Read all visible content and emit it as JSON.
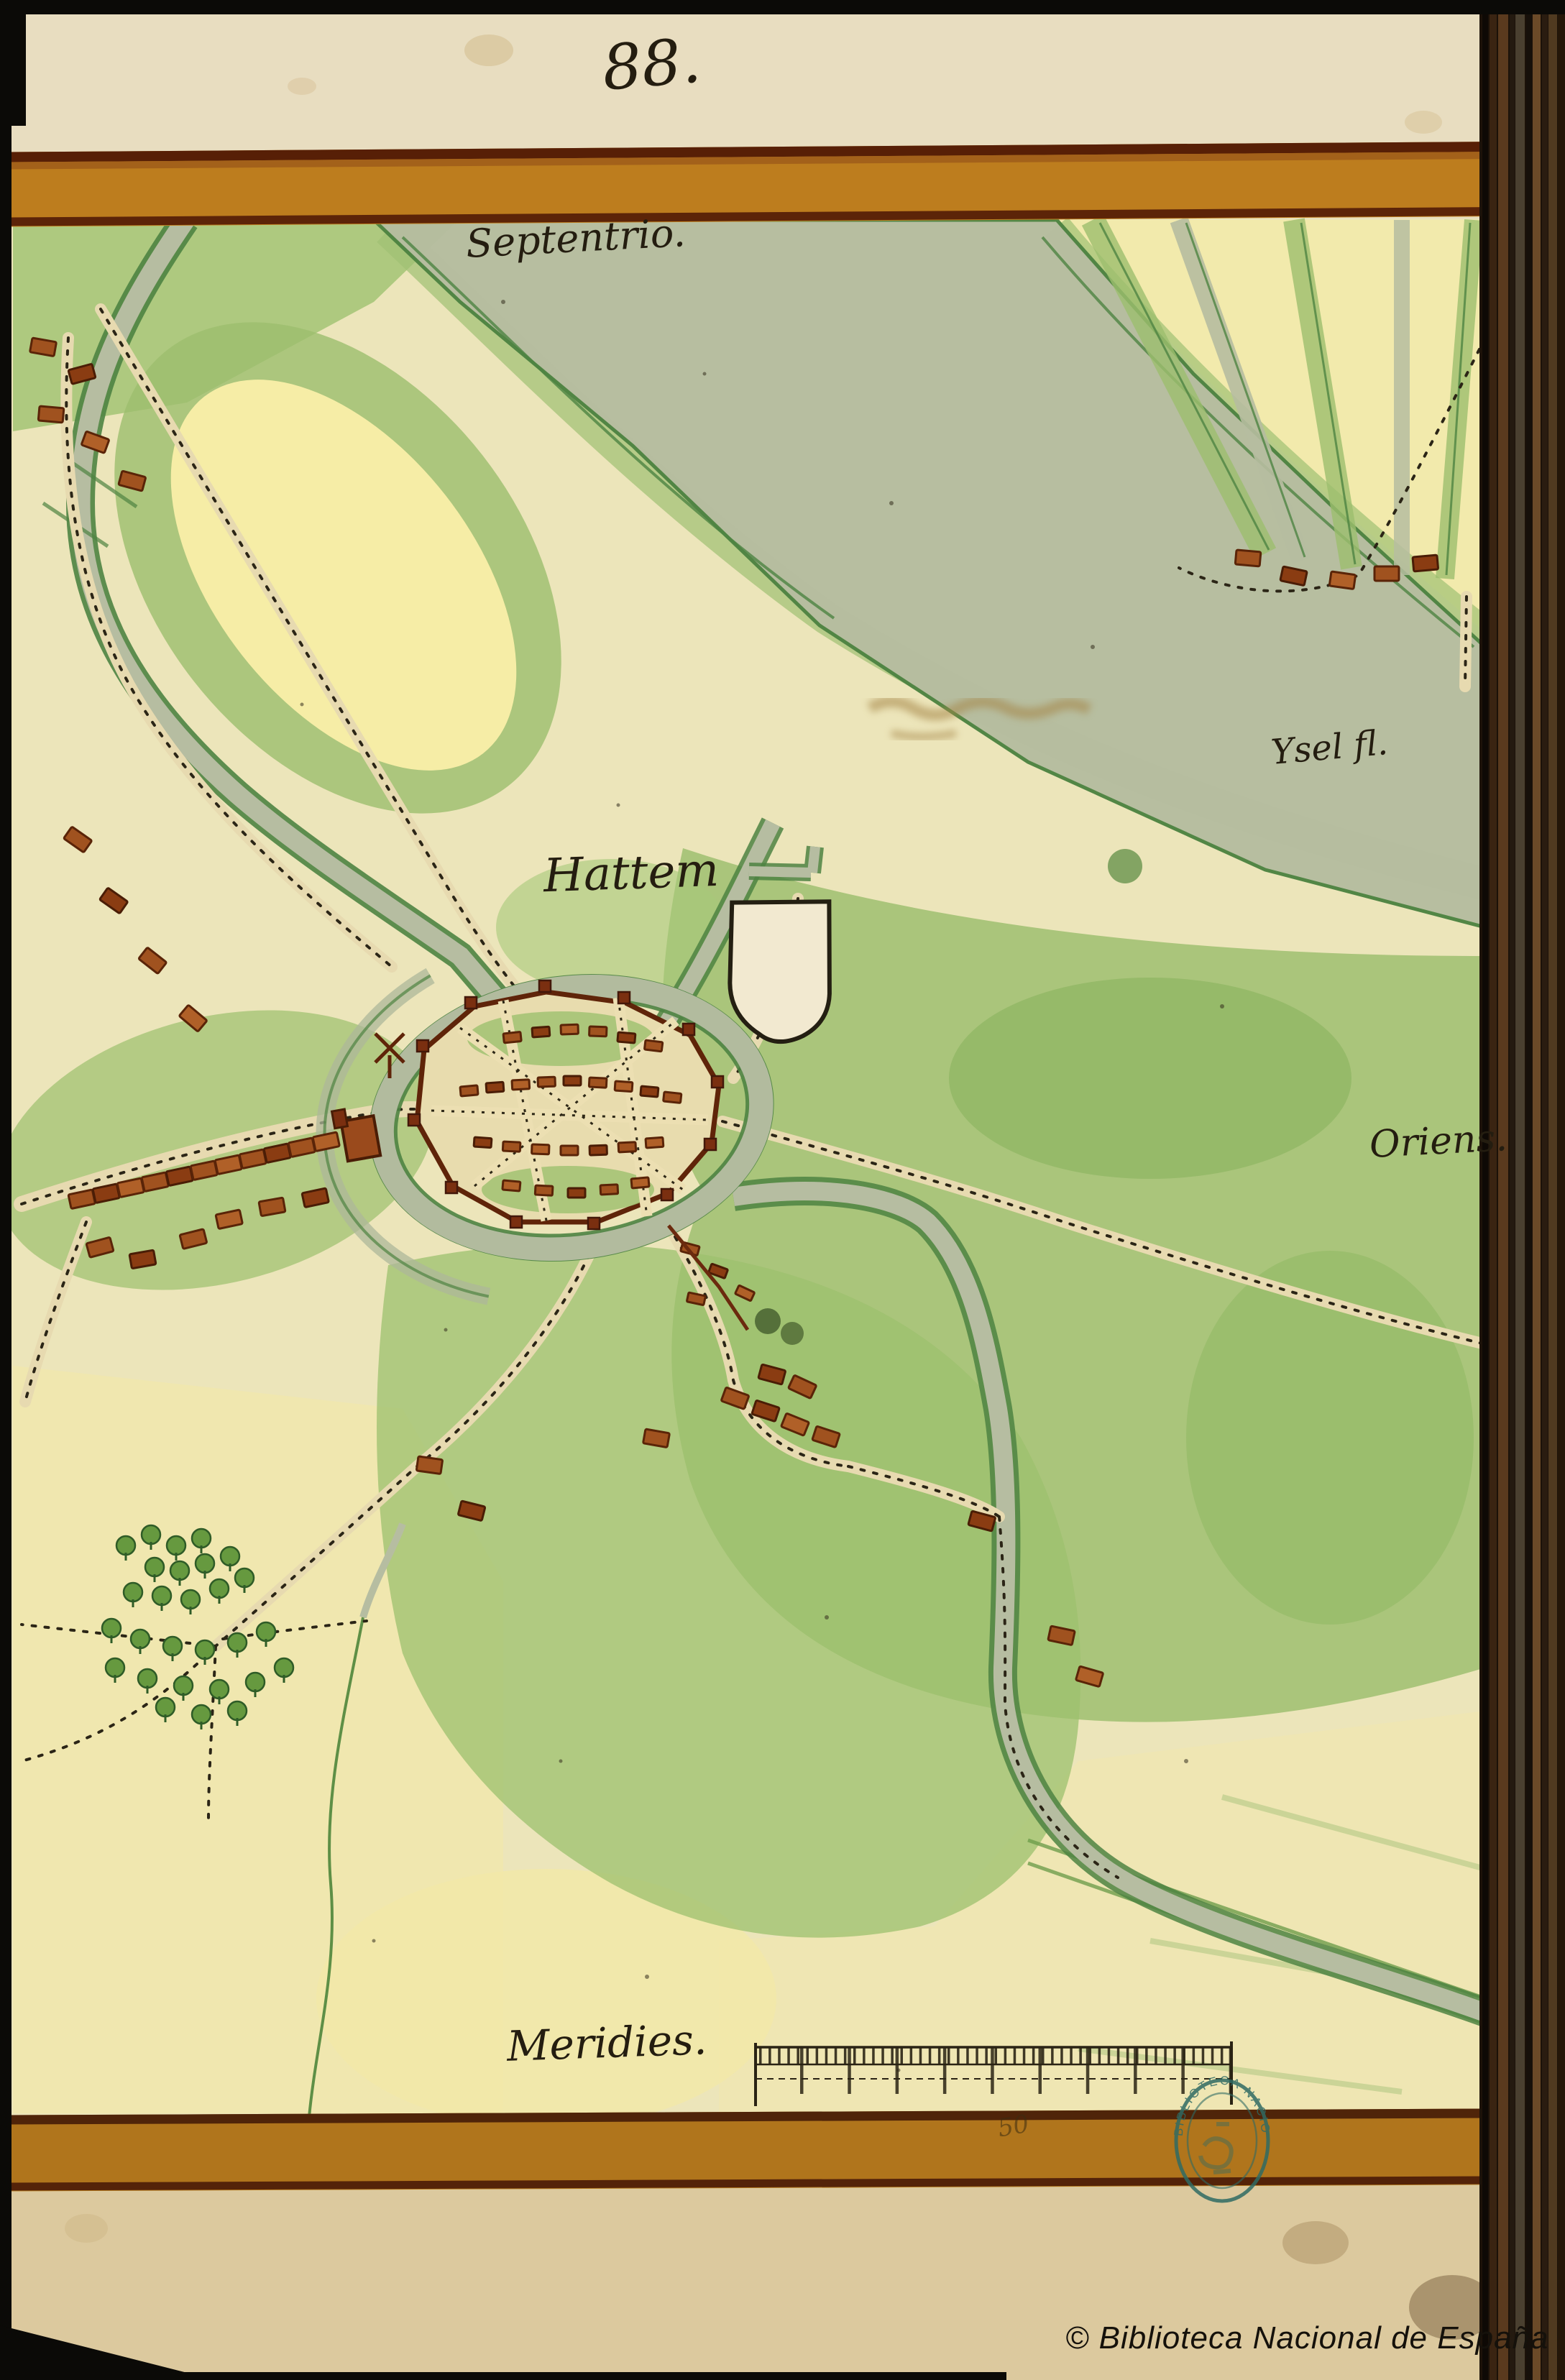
{
  "page": {
    "folio_number": "88.",
    "band_inscription": "50"
  },
  "map": {
    "labels": {
      "north": "Septentrio.",
      "south": "Meridies.",
      "east": "Oriens.",
      "town": "Hattem",
      "river": "Ysel fl."
    },
    "stamp": {
      "arc_text": "BIBLIOTECA NACIONAL"
    },
    "scale_bar": {
      "major_divisions": 10,
      "minor_ticks_per_division": 5
    },
    "features": {
      "town_name": "Hattem",
      "river_name": "Ysel fl.",
      "empty_heraldic_shield": true,
      "windmill": true
    }
  },
  "footer": {
    "copyright": "© Biblioteca Nacional de España"
  },
  "colors": {
    "parchment": "#e9dfbd",
    "map_cream": "#ece5ba",
    "pale_field": "#f4eca8",
    "field_green": "#9cc06e",
    "water_grey": "#b6bda1",
    "ink_green": "#4e8342",
    "road_beige": "#e7dab0",
    "building_red": "#a0521f",
    "frame_ochre": "#bd7d1e",
    "frame_edge_brown": "#571f06",
    "stamp_teal": "#2f6b64",
    "frame_black": "#0b0a07"
  }
}
